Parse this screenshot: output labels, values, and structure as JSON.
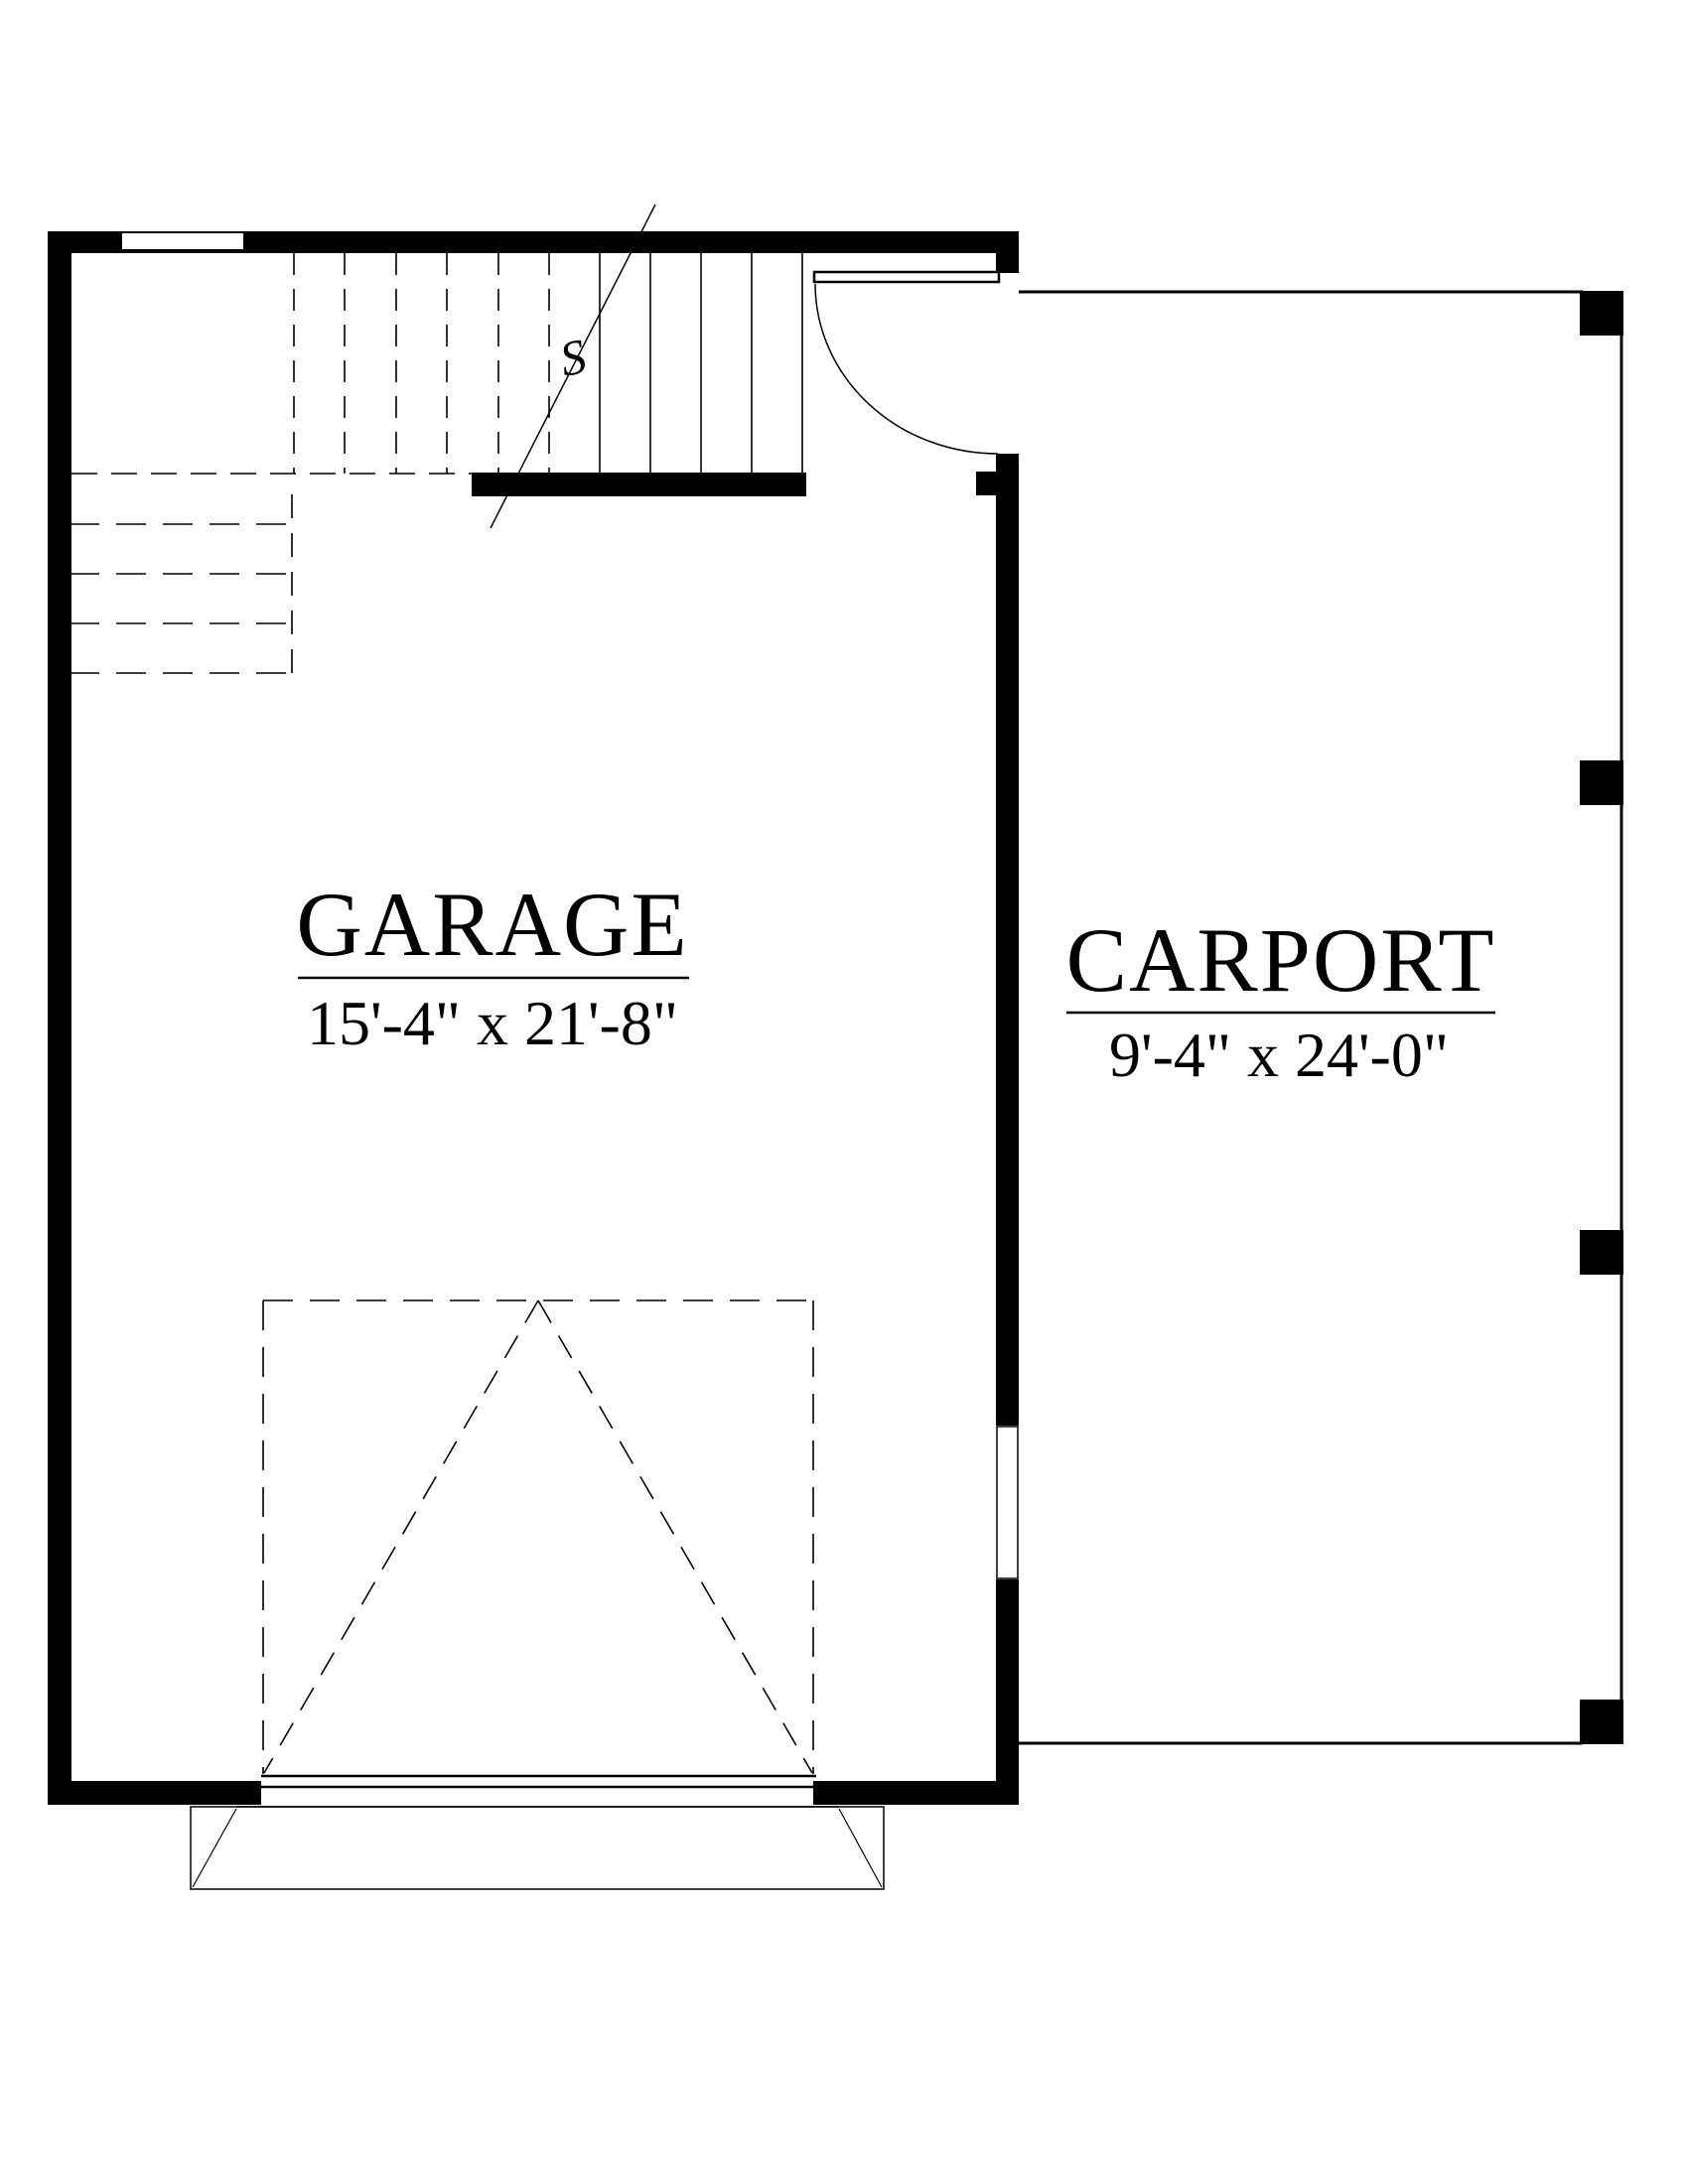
{
  "drawing": {
    "type": "floor-plan",
    "paper_color": "#ffffff",
    "ink_color": "#000000"
  },
  "rooms": [
    {
      "id": "garage",
      "label": "GARAGE",
      "dimensions": "15'-4\" x 21'-8\""
    },
    {
      "id": "carport",
      "label": "CARPORT",
      "dimensions": "9'-4\" x 24'-0\""
    }
  ],
  "annotations": {
    "stair_break_symbol": "S"
  }
}
